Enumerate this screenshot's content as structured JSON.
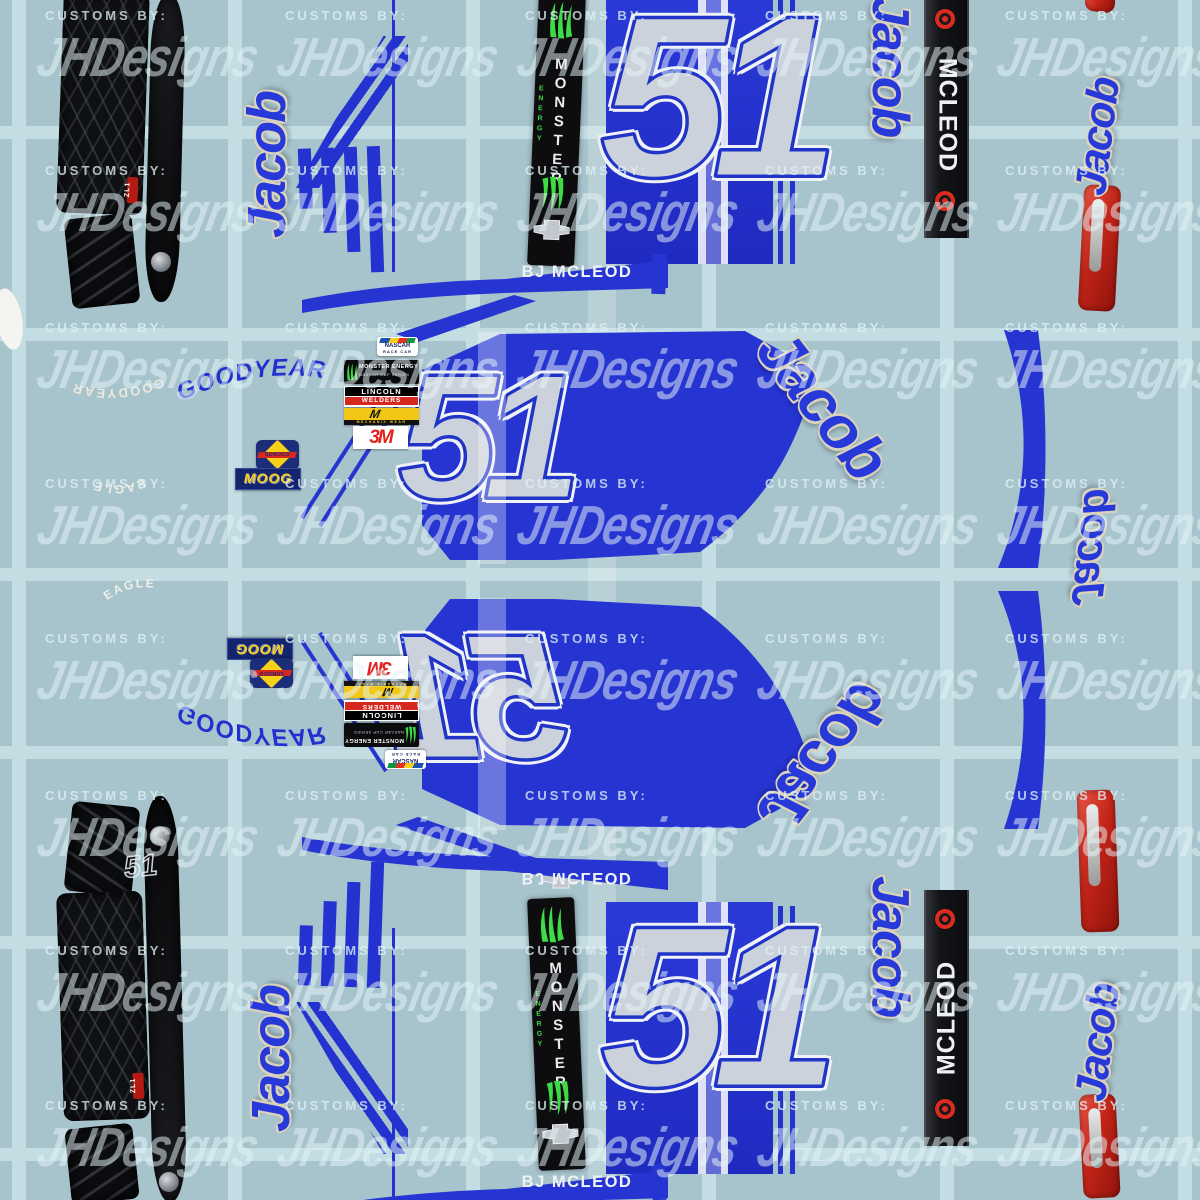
{
  "branding": {
    "watermark_prefix": "CUSTOMS BY:",
    "watermark_name": "JHDesigns"
  },
  "car": {
    "number": "51",
    "driver_first_name": "Jacob",
    "driver_display_name": "BJ MCLEOD",
    "roof_rail_name": "MCLEOD",
    "model_badge": "ZL1"
  },
  "sponsors": {
    "monster": {
      "name": "MONSTER",
      "sub": "ENERGY"
    },
    "monster_cup": {
      "line1": "MONSTER ENERGY",
      "line2": "NASCAR CUP SERIES"
    },
    "goodyear": {
      "name": "GOODYEAR",
      "tire_line": "EAGLE"
    },
    "sunoco": {
      "name": "SUNOCO"
    },
    "moog": {
      "name": "MOOG"
    },
    "threem": {
      "name": "3M"
    },
    "lincoln": {
      "line1": "LINCOLN",
      "line2": "WELDERS"
    },
    "mechanix": {
      "name": "MECHANIX WEAR"
    },
    "nascar_racecar": {
      "line1": "NASCAR",
      "line2": "RACE CAR"
    }
  },
  "colors": {
    "background": "#a7c3cc",
    "grid_line": "#c3dde2",
    "accent_blue": "#2433cf",
    "number_silver": "#ccd2db",
    "monster_green": "#3ddb44",
    "tail_light_red": "#c3251f",
    "watermark": "#dff2f6"
  },
  "watermark_grid": {
    "xs": [
      45,
      285,
      525,
      765,
      1005
    ],
    "ys": [
      8,
      163,
      320,
      476,
      631,
      788,
      943,
      1098
    ]
  }
}
